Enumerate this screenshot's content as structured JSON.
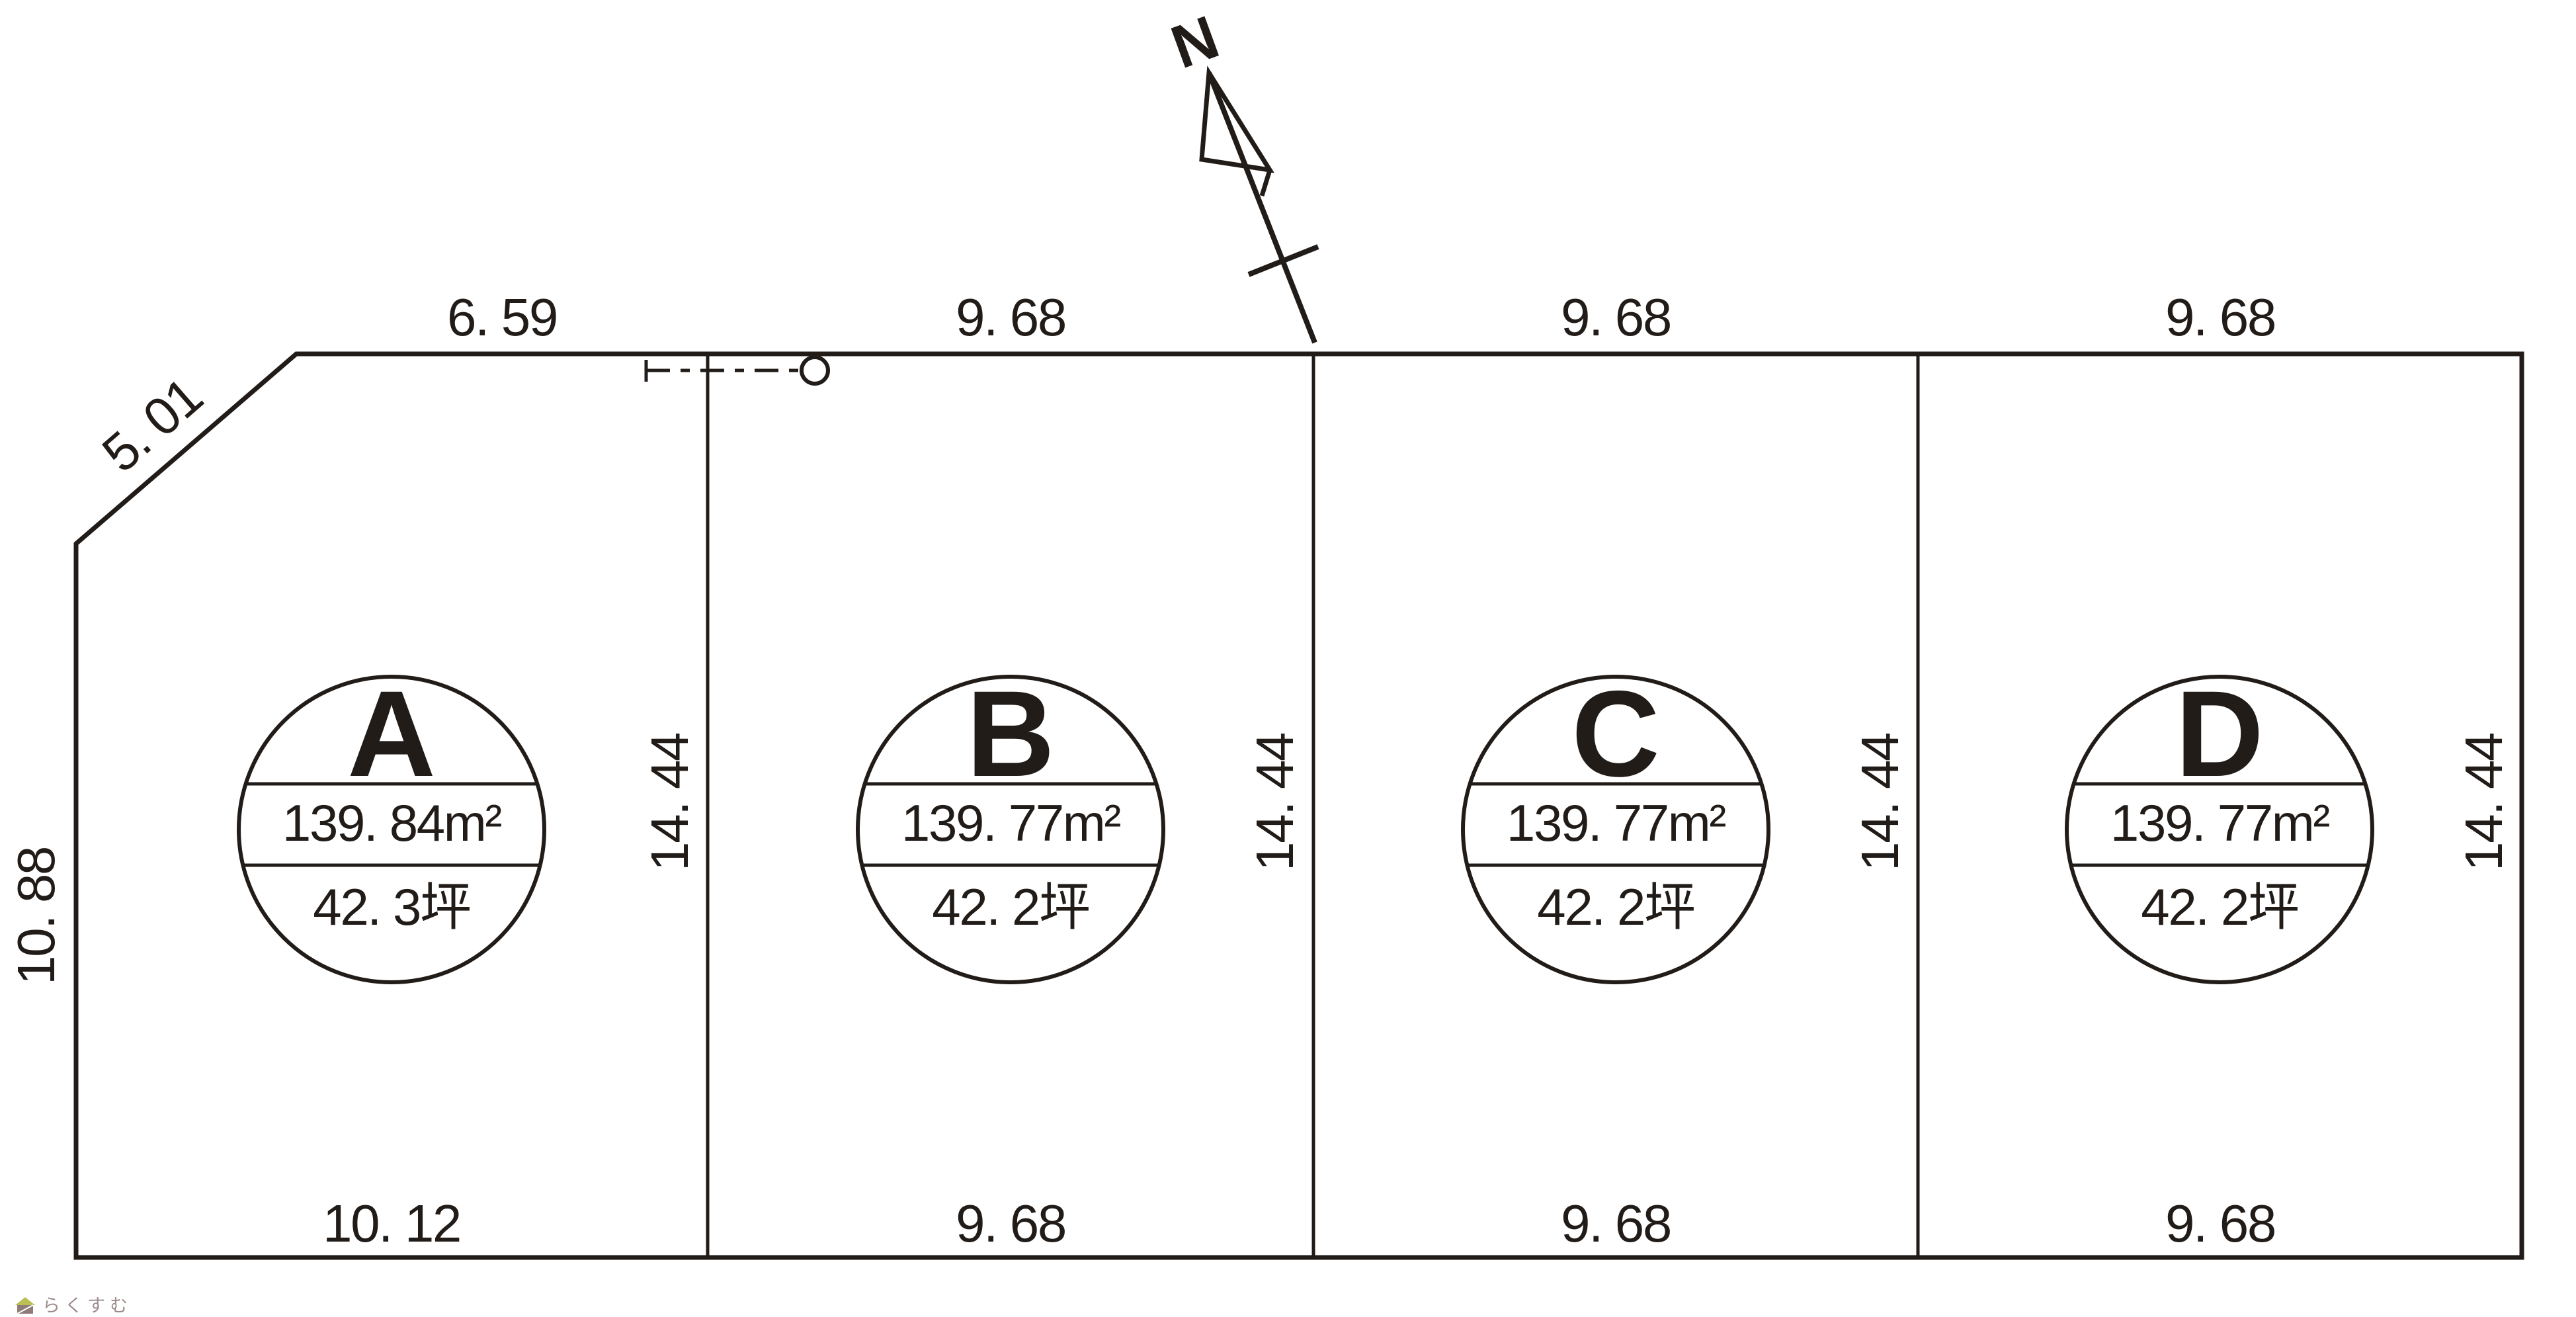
{
  "compass": {
    "north_label": "N"
  },
  "dimensions": {
    "top": [
      "6. 59",
      "9. 68",
      "9. 68",
      "9. 68"
    ],
    "bottom": [
      "10. 12",
      "9. 68",
      "9. 68",
      "9. 68"
    ],
    "vertical_right": [
      "14. 44",
      "14. 44",
      "14. 44",
      "14. 44"
    ],
    "left_side": "10. 88",
    "diagonal": "5. 01"
  },
  "lots": [
    {
      "label": "A",
      "area_sqm": "139. 84m²",
      "area_tsubo": "42. 3坪"
    },
    {
      "label": "B",
      "area_sqm": "139. 77m²",
      "area_tsubo": "42. 2坪"
    },
    {
      "label": "C",
      "area_sqm": "139. 77m²",
      "area_tsubo": "42. 2坪"
    },
    {
      "label": "D",
      "area_sqm": "139. 77m²",
      "area_tsubo": "42. 2坪"
    }
  ],
  "watermark": {
    "text": "らくすむ"
  },
  "colors": {
    "line": "#221c19",
    "watermark_text": "#9c8b8b",
    "watermark_roof": "#b9c054",
    "watermark_body": "#8d7d76"
  }
}
